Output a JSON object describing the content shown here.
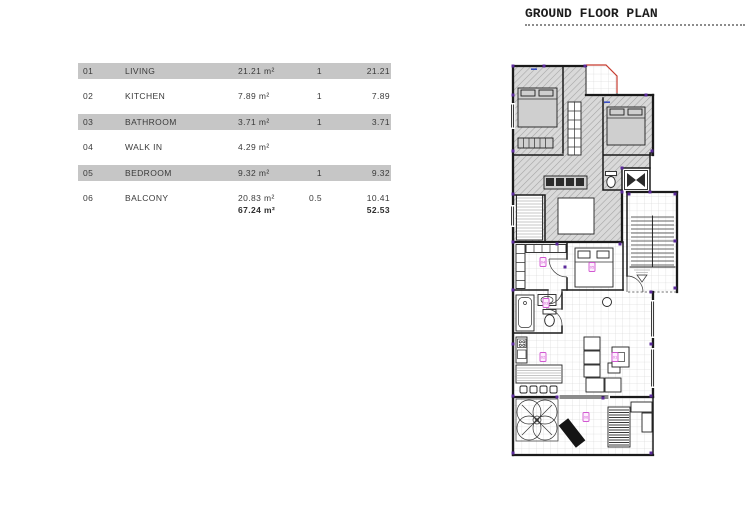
{
  "header": {
    "title": "GROUND FLOOR PLAN"
  },
  "area_table": {
    "rows": [
      {
        "num": "01",
        "name": "LIVING",
        "area": "21.21 m²",
        "factor": "1",
        "value": "21.21"
      },
      {
        "num": "02",
        "name": "KITCHEN",
        "area": "7.89 m²",
        "factor": "1",
        "value": "7.89"
      },
      {
        "num": "03",
        "name": "BATHROOM",
        "area": "3.71 m²",
        "factor": "1",
        "value": "3.71"
      },
      {
        "num": "04",
        "name": "WALK IN",
        "area": "4.29 m²",
        "factor": "",
        "value": ""
      },
      {
        "num": "05",
        "name": "BEDROOM",
        "area": "9.32 m²",
        "factor": "1",
        "value": "9.32"
      },
      {
        "num": "06",
        "name": "BALCONY",
        "area": "20.83 m²",
        "factor": "0.5",
        "value": "10.41"
      }
    ],
    "totals": {
      "area": "67.24 m²",
      "value": "52.53"
    }
  },
  "floor_plan": {
    "room_labels": [
      {
        "id": "01",
        "room": "living"
      },
      {
        "id": "02",
        "room": "kitchen"
      },
      {
        "id": "03",
        "room": "bathroom"
      },
      {
        "id": "04",
        "room": "walk-in"
      },
      {
        "id": "05",
        "room": "bedroom"
      },
      {
        "id": "06",
        "room": "balcony"
      }
    ]
  },
  "colors": {
    "band": "#c6c6c6",
    "text": "#3a3a3a",
    "wall": "#1a1a1a",
    "hatch_fill": "#d9d9d9",
    "hatch_line": "#a3a3a3",
    "grid_line": "#cdcdcd",
    "marker_purple": "#5b2a9b",
    "label_magenta": "#d157d1",
    "terrace_red": "#c63b2f",
    "window_blue": "#3a4fc4",
    "dotted": "#8c8c8c"
  }
}
